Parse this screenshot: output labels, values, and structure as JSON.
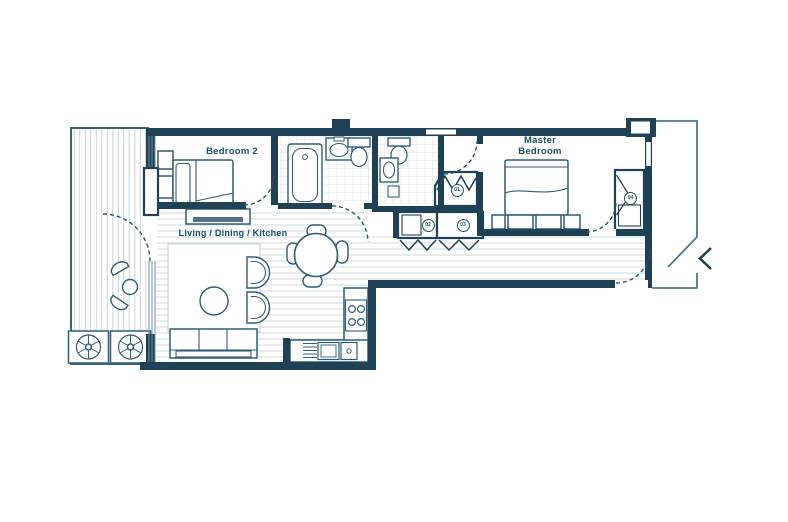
{
  "page": {
    "type": "architectural floor plan",
    "background": "#ffffff"
  },
  "rooms": {
    "bedroom2_label": "Bedroom 2",
    "master_label_line1": "Master",
    "master_label_line2": "Bedroom",
    "living_label": "Living / Dining / Kitchen"
  },
  "markers": {
    "m01": "01",
    "m02": "02",
    "m03": "03",
    "m04": "04"
  },
  "symbols": [
    "entrance-chevron-icon",
    "door-swing-arc",
    "bathtub",
    "toilet",
    "washbasin",
    "single-bed",
    "double-bed",
    "sofa",
    "armchair",
    "coffee-table",
    "dining-table",
    "dining-chair",
    "kitchen-hob",
    "kitchen-sink",
    "wardrobe",
    "balcony-planter",
    "balcony-chair",
    "balcony-table"
  ],
  "colors": {
    "wall": "#1e4156",
    "floor_hatch": "#cfd8df",
    "tile": "#d6dee4",
    "label_text": "#164f68"
  }
}
